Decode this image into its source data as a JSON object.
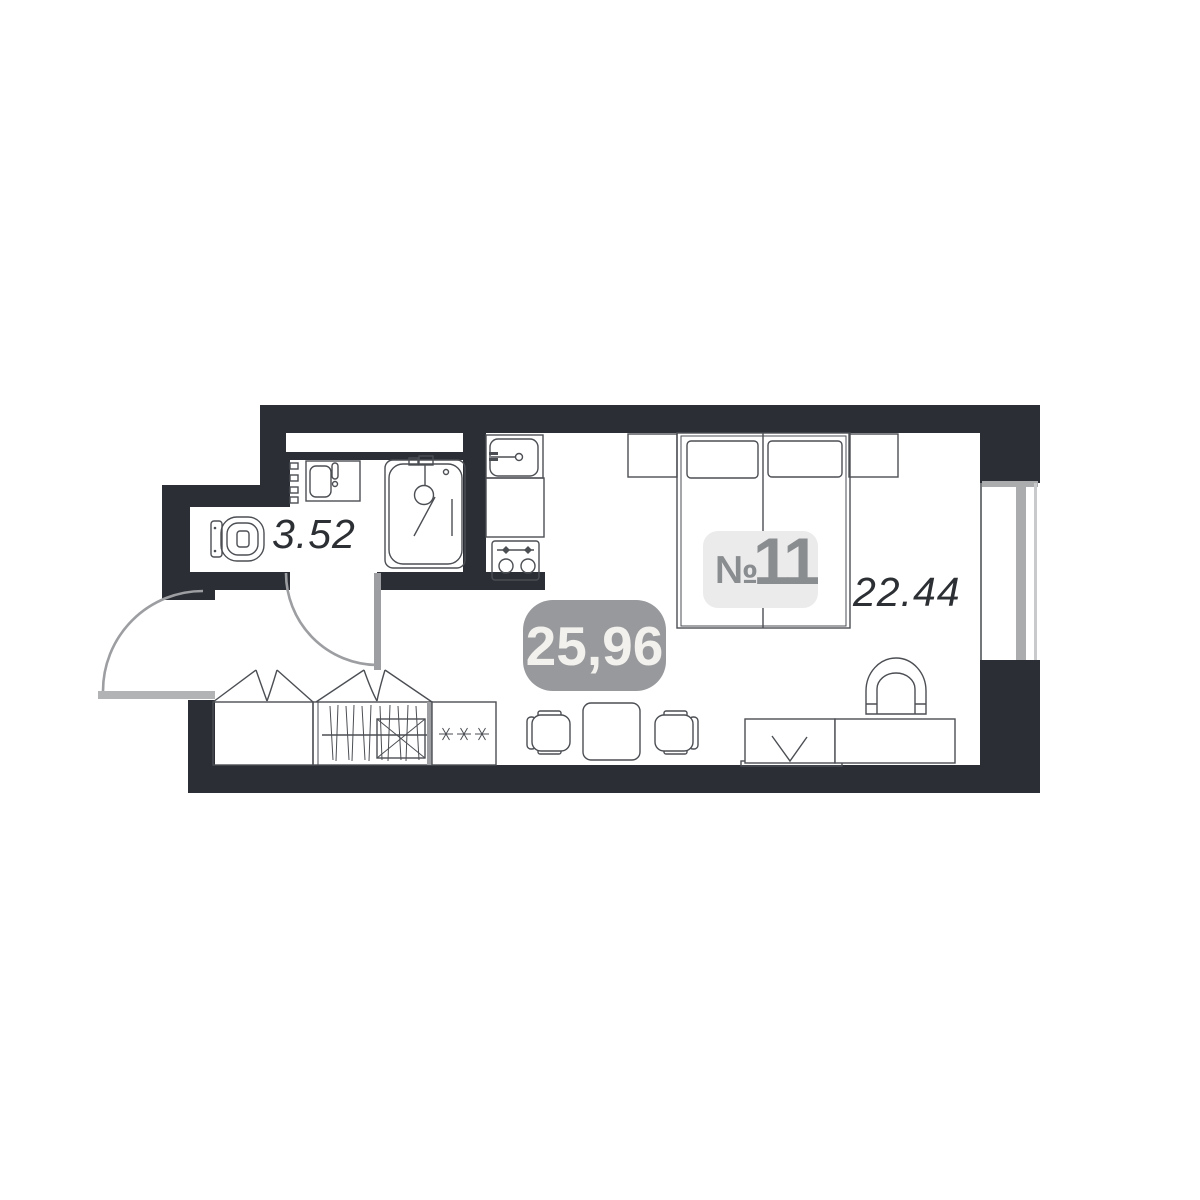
{
  "plan": {
    "unit_number_sign": "№",
    "unit_number": "11",
    "total_area": "25,96",
    "bathroom_area": "3.52",
    "living_area": "22.44"
  },
  "colors": {
    "wall": "#2b2e35",
    "line": "#4b4e53",
    "door": "#9c9ea1",
    "entry_door": "#b1b3b5",
    "window_frame": "#aaacae",
    "unit_badge_bg": "#ebebec",
    "unit_badge_text": "#8a8d90",
    "total_badge_bg": "#97999c",
    "total_badge_text": "#f2f1ed",
    "area_label_text": "#2c2f33"
  }
}
